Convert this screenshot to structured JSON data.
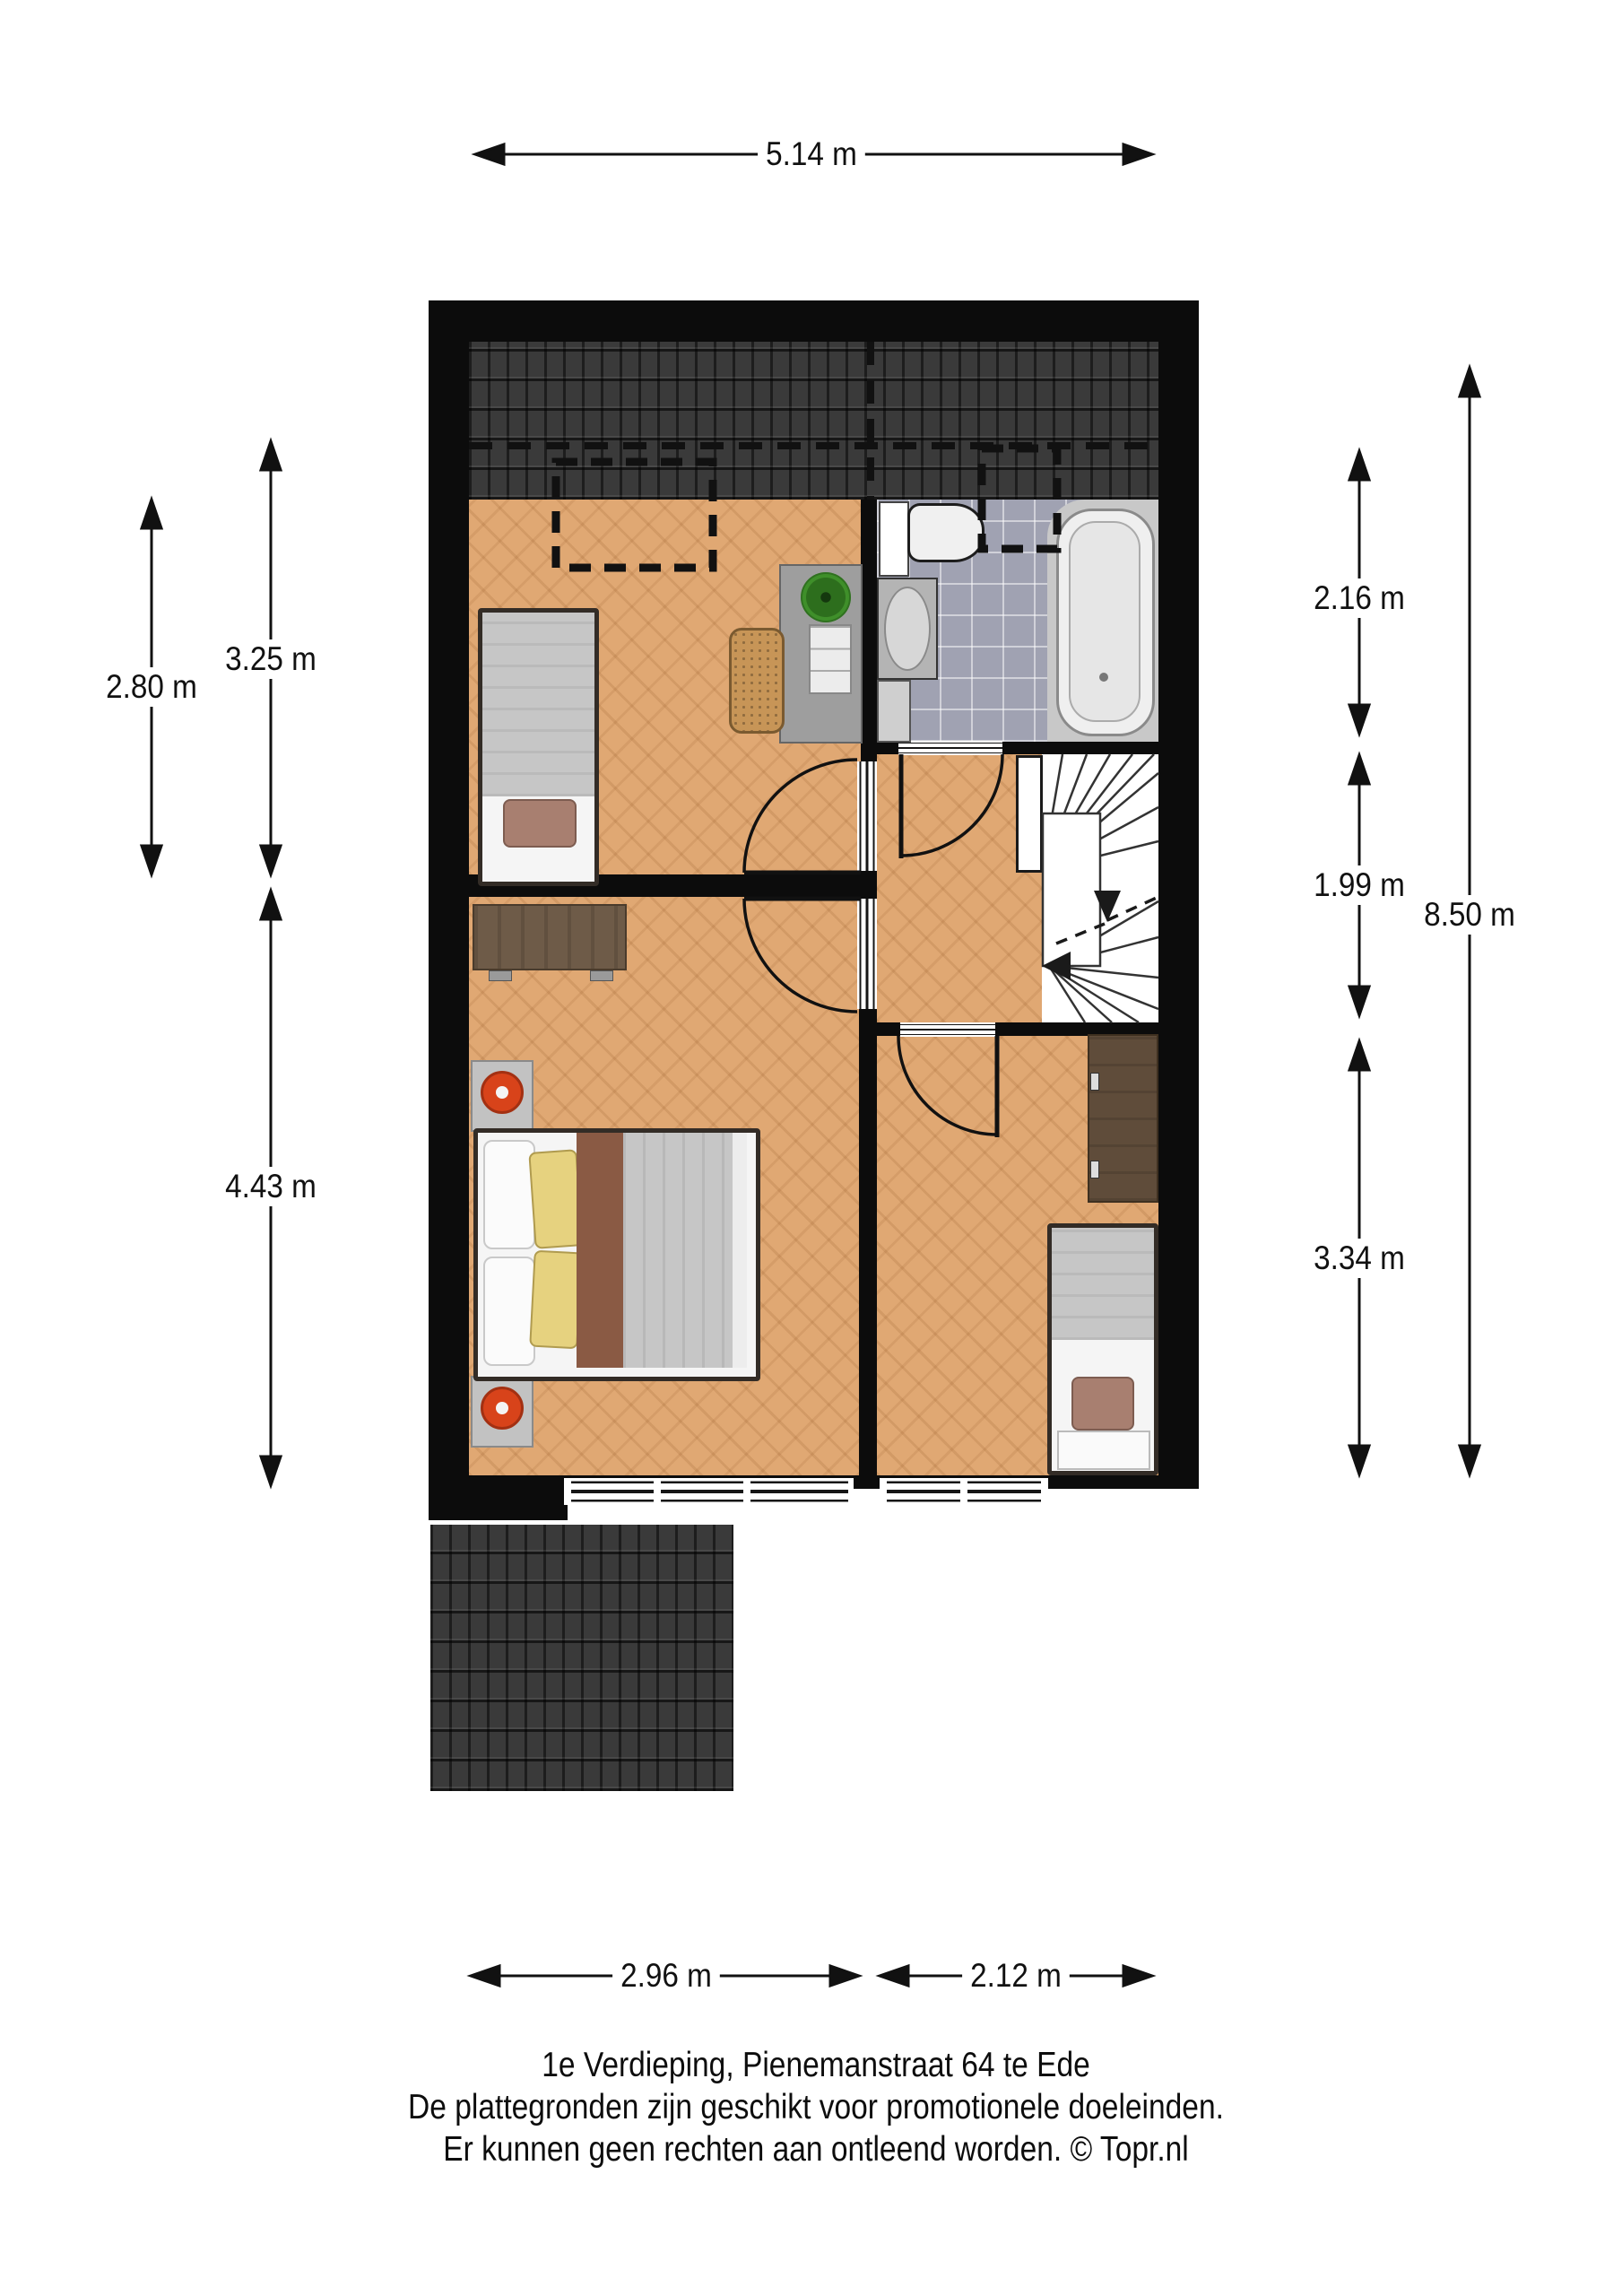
{
  "dimensions": {
    "top": "5.14 m",
    "left": [
      "2.80 m",
      "3.25 m",
      "4.43 m"
    ],
    "right": [
      "2.16 m",
      "1.99 m",
      "3.34 m",
      "8.50 m"
    ],
    "bottom": [
      "2.96 m",
      "2.12 m"
    ]
  },
  "caption": [
    "1e Verdieping, Pienemanstraat 64 te Ede",
    "De plattegronden zijn geschikt voor promotionele doeleinden.",
    "Er kunnen geen rechten aan ontleend worden. © Topr.nl"
  ],
  "colors": {
    "wall": "#0c0c0c",
    "parquet_floor": "#e0a873",
    "roof_tiles": "#3a3a3a",
    "bathroom_tiles": "#a0a2b2",
    "accent_orange": "#d8431a"
  }
}
